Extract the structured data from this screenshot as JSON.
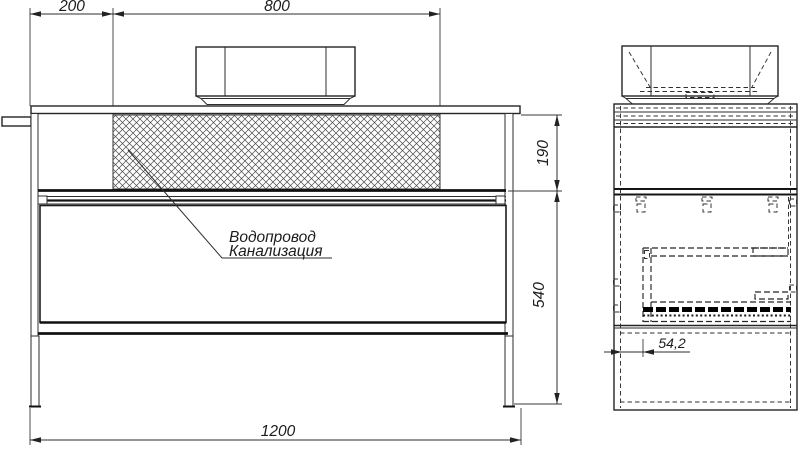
{
  "drawing": {
    "type": "technical-drawing",
    "views": {
      "front": "front view of vanity with vessel sink",
      "side": "side view of vanity"
    },
    "labels": {
      "pipe_note_line1": "Водопровод",
      "pipe_note_line2": "Канализация"
    },
    "dimensions": {
      "top_left": "200",
      "top_center": "800",
      "right_upper": "190",
      "right_lower": "540",
      "bottom": "1200",
      "side_depth": "54,2"
    },
    "colors": {
      "line": "#222222",
      "background": "#ffffff",
      "hatch": "#4a4a4a"
    }
  }
}
